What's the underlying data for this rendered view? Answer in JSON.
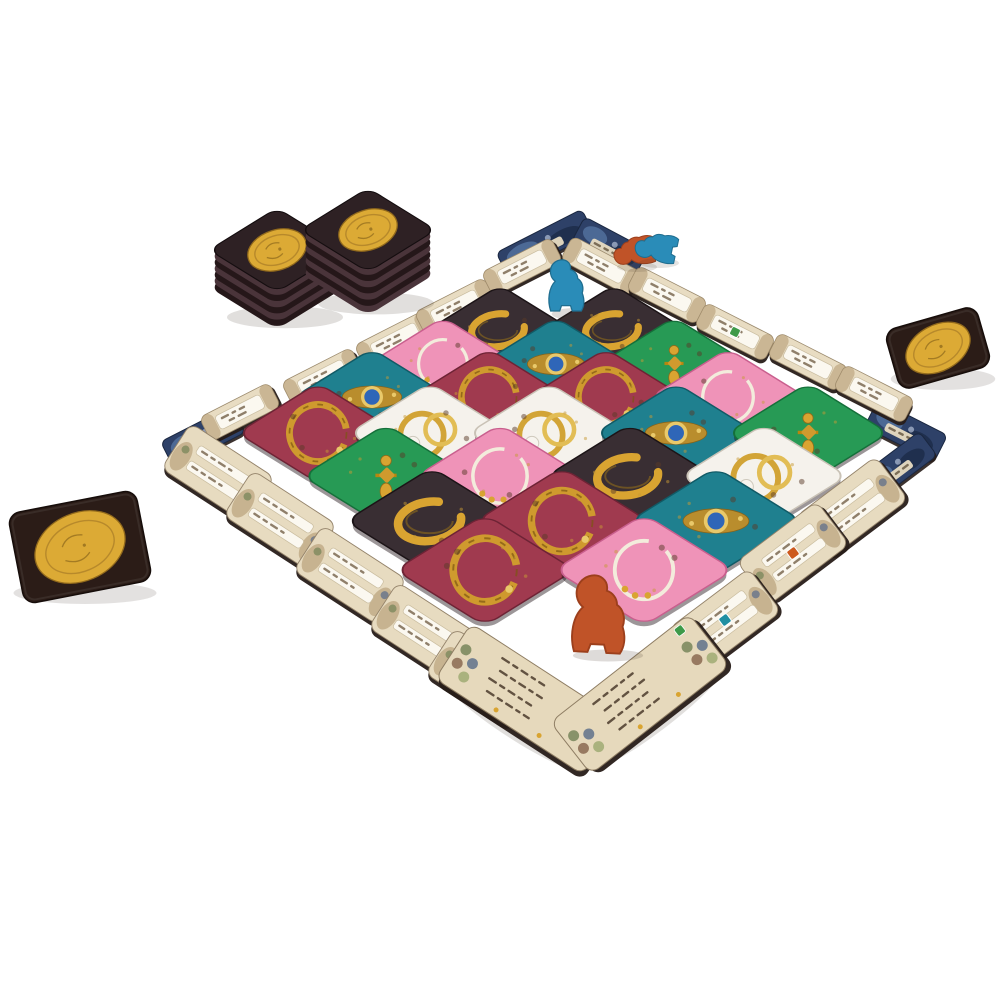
{
  "palette": {
    "background": "#ffffff",
    "gold": "#d9a431",
    "gold_dark": "#8f6a1a",
    "gold_pale": "#e9c96a",
    "parchment": "#e8dcc2",
    "label_white": "#fbf8f0",
    "card_edge_dark": "#271c18",
    "corner_art_blue": "#2e4168",
    "coin_card_brown": "#2b1c17",
    "coin_gold": "#dcaa35",
    "meeple_blue": "#2a8cb8",
    "meeple_orange": "#c05328",
    "tile_colors": {
      "black": [
        "#392e33",
        "#1c1417"
      ],
      "maroon": [
        "#a03a4f",
        "#6e2335"
      ],
      "pink": [
        "#ef93b8",
        "#c95f8e"
      ],
      "teal": [
        "#1f808f",
        "#115a66"
      ],
      "green": [
        "#279a55",
        "#15703a"
      ],
      "white": [
        "#f5f2ec",
        "#c9c2b6"
      ]
    },
    "icon_colors": {
      "green": "#3e9a49",
      "orange": "#cd5a1e",
      "teal": "#208fa2"
    }
  },
  "board": {
    "tiles_total": 23,
    "ornament_icons": {
      "black": "gold-bangle-icon",
      "maroon": "ornate-gold-necklace-icon",
      "pink": "pearl-chain-necklace-icon",
      "teal": "blue-gem-brooch-icon",
      "green": "gold-earring-icon",
      "white": "gold-rings-pearl-icon"
    },
    "grid_rows": [
      {
        "y": 330,
        "size": 102,
        "tiles": [
          {
            "x": 500,
            "c": "black"
          },
          {
            "x": 614,
            "c": "black"
          }
        ]
      },
      {
        "y": 364,
        "size": 106,
        "tiles": [
          {
            "x": 443,
            "c": "pink"
          },
          {
            "x": 556,
            "c": "teal"
          },
          {
            "x": 674,
            "c": "green"
          }
        ]
      },
      {
        "y": 397,
        "size": 110,
        "tiles": [
          {
            "x": 372,
            "c": "teal"
          },
          {
            "x": 489,
            "c": "maroon"
          },
          {
            "x": 606,
            "c": "maroon"
          },
          {
            "x": 728,
            "c": "pink"
          }
        ]
      },
      {
        "y": 433,
        "size": 114,
        "tiles": [
          {
            "x": 318,
            "c": "maroon"
          },
          {
            "x": 430,
            "c": "white"
          },
          {
            "x": 549,
            "c": "white"
          },
          {
            "x": 676,
            "c": "teal"
          },
          {
            "x": 808,
            "c": "green"
          }
        ]
      },
      {
        "y": 476,
        "size": 118,
        "tiles": [
          {
            "x": 386,
            "c": "green"
          },
          {
            "x": 500,
            "c": "pink"
          },
          {
            "x": 630,
            "c": "black"
          },
          {
            "x": 764,
            "c": "white"
          }
        ]
      },
      {
        "y": 521,
        "size": 122,
        "tiles": [
          {
            "x": 432,
            "c": "black"
          },
          {
            "x": 562,
            "c": "maroon"
          },
          {
            "x": 716,
            "c": "teal"
          }
        ]
      },
      {
        "y": 570,
        "size": 127,
        "tiles": [
          {
            "x": 485,
            "c": "maroon"
          },
          {
            "x": 644,
            "c": "pink"
          }
        ]
      }
    ],
    "border": {
      "small_cards": [
        {
          "x": 240,
          "y": 412,
          "a": -27
        },
        {
          "x": 322,
          "y": 377,
          "a": -27
        },
        {
          "x": 395,
          "y": 340,
          "a": -27
        },
        {
          "x": 455,
          "y": 307,
          "a": -27
        },
        {
          "x": 522,
          "y": 267,
          "a": -27
        },
        {
          "x": 601,
          "y": 266,
          "a": 28
        },
        {
          "x": 667,
          "y": 295,
          "a": 27
        },
        {
          "x": 735,
          "y": 332,
          "a": 27,
          "icon": "green"
        },
        {
          "x": 808,
          "y": 362,
          "a": 27
        },
        {
          "x": 874,
          "y": 394,
          "a": 27
        }
      ],
      "large_cards": [
        {
          "x": 218,
          "y": 473,
          "a": 33
        },
        {
          "x": 280,
          "y": 520,
          "a": 33
        },
        {
          "x": 350,
          "y": 575,
          "a": 33
        },
        {
          "x": 425,
          "y": 632,
          "a": 33
        },
        {
          "x": 482,
          "y": 678,
          "a": 33
        },
        {
          "x": 852,
          "y": 508,
          "a": -37
        },
        {
          "x": 793,
          "y": 553,
          "a": -37,
          "icon": "orange"
        },
        {
          "x": 725,
          "y": 620,
          "a": -37,
          "icon": "teal"
        }
      ],
      "corner_art_cards": [
        {
          "x": 545,
          "y": 243,
          "a": -27,
          "w": 96,
          "h": 27
        },
        {
          "x": 610,
          "y": 246,
          "a": 28,
          "w": 72,
          "h": 28
        },
        {
          "x": 203,
          "y": 437,
          "a": -27,
          "w": 80,
          "h": 30
        },
        {
          "x": 209,
          "y": 470,
          "a": 33,
          "w": 80,
          "h": 30
        },
        {
          "x": 906,
          "y": 431,
          "a": 27,
          "w": 78,
          "h": 30
        },
        {
          "x": 897,
          "y": 467,
          "a": -37,
          "w": 78,
          "h": 30
        }
      ],
      "reference_cards": [
        {
          "x": 527,
          "y": 699,
          "a": 33,
          "icon": null
        },
        {
          "x": 640,
          "y": 694,
          "a": -38,
          "icon": "green"
        }
      ]
    }
  },
  "tokens": {
    "coin_stacks": [
      {
        "x": 277,
        "y": 250,
        "layers": 6
      },
      {
        "x": 368,
        "y": 230,
        "layers": 7
      }
    ],
    "coin_cards": [
      {
        "x": 80,
        "y": 547,
        "w": 130,
        "h": 92,
        "a": -11
      },
      {
        "x": 938,
        "y": 348,
        "w": 95,
        "h": 62,
        "a": -16
      }
    ]
  },
  "meeples": [
    {
      "name": "blue-meeple-standing",
      "color": "blue",
      "x": 566,
      "y": 284,
      "s": 0.9,
      "a": 0,
      "standing": true
    },
    {
      "name": "orange-meeple-lying",
      "color": "orange",
      "x": 633,
      "y": 251,
      "s": 0.72,
      "a": -95,
      "standing": false
    },
    {
      "name": "blue-meeple-lying",
      "color": "blue",
      "x": 655,
      "y": 247,
      "s": 0.72,
      "a": -78,
      "standing": false
    },
    {
      "name": "orange-meeple-standing",
      "color": "orange",
      "x": 599,
      "y": 612,
      "s": 1.35,
      "a": 3,
      "standing": true
    }
  ]
}
